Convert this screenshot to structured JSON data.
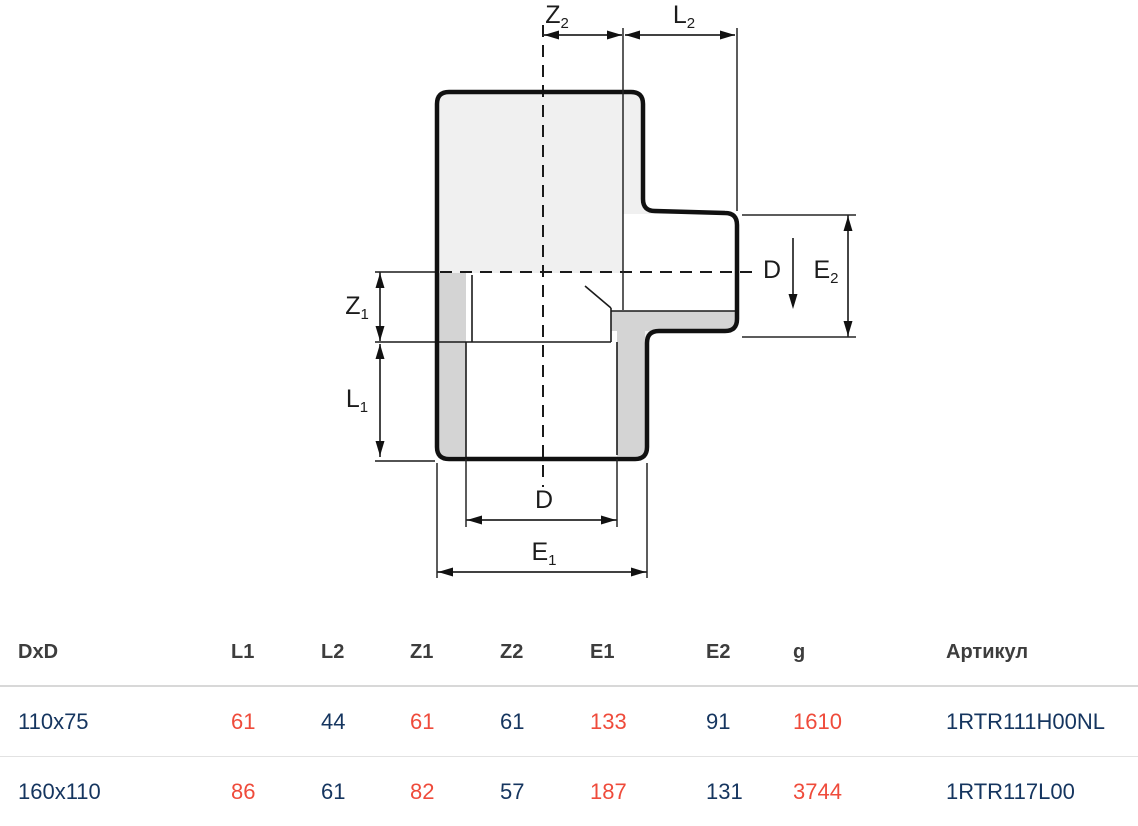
{
  "diagram": {
    "labels": {
      "z2": {
        "base": "Z",
        "sub": "2"
      },
      "l2": {
        "base": "L",
        "sub": "2"
      },
      "z1": {
        "base": "Z",
        "sub": "1"
      },
      "l1": {
        "base": "L",
        "sub": "1"
      },
      "d_bottom": {
        "base": "D",
        "sub": ""
      },
      "e1": {
        "base": "E",
        "sub": "1"
      },
      "d_side": {
        "base": "D",
        "sub": ""
      },
      "e2": {
        "base": "E",
        "sub": "2"
      }
    },
    "colors": {
      "body_fill": "#f0f0f0",
      "wall_fill": "#d4d4d4",
      "outline": "#111111",
      "thin_line": "#1a1a1a",
      "dim_line": "#262626"
    }
  },
  "table": {
    "headers": [
      "DxD",
      "L1",
      "L2",
      "Z1",
      "Z2",
      "E1",
      "E2",
      "g",
      "Артикул"
    ],
    "rows": [
      [
        "110x75",
        "61",
        "44",
        "61",
        "61",
        "133",
        "91",
        "1610",
        "1RTR111H00NL"
      ],
      [
        "160x110",
        "86",
        "61",
        "82",
        "57",
        "187",
        "131",
        "3744",
        "1RTR117L00"
      ]
    ],
    "colors": {
      "header_text": "#3d3d3d",
      "value_text": "#15355f",
      "accent_text": "#ef4b3b",
      "divider": "#d8d8d8"
    }
  }
}
